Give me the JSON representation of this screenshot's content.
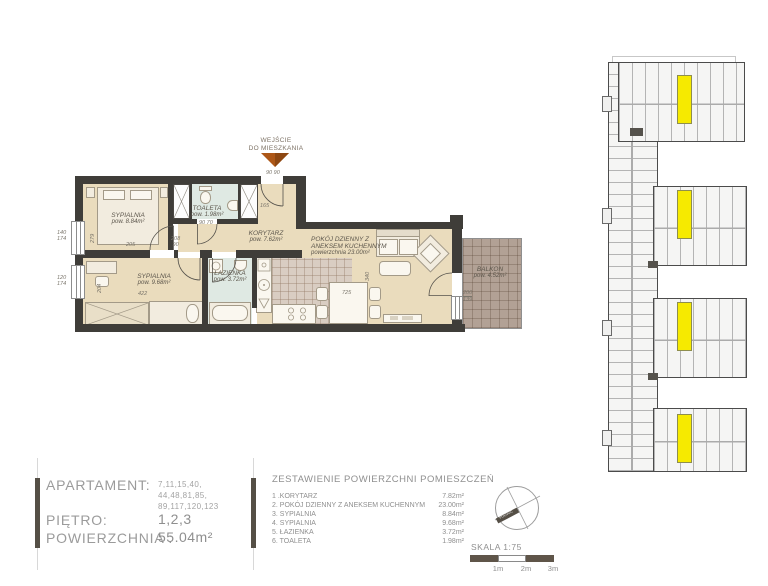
{
  "plan": {
    "entrance": {
      "line1": "WEJŚCIE",
      "line2": "DO MIESZKANIA"
    },
    "rooms": {
      "bedroom1": {
        "name": "SYPIALNIA",
        "area": "pow. 8.84m²"
      },
      "toilet": {
        "name": "TOALETA",
        "area": "pow. 1.98m²"
      },
      "corridor": {
        "name": "KORYTARZ",
        "area": "pow. 7.62m²"
      },
      "living": {
        "name_line1": "POKÓJ DZIENNY Z",
        "name_line2": "ANEKSEM KUCHENNYM",
        "area": "powierzchnia 23.00m²"
      },
      "bedroom2": {
        "name": "SYPIALNIA",
        "area": "pow. 9.68m²"
      },
      "bathroom": {
        "name": "ŁAZIENKA",
        "area": "pow. 3.72m²"
      },
      "balcony": {
        "name": "BALKON",
        "area": "pow. 4.52m²"
      }
    },
    "dims": {
      "bedroom1_w": "205",
      "bedroom1_h": "279",
      "bedroom1_door": "208",
      "bedroom1_door_w": "90",
      "window1_w": "140",
      "window1_h": "174",
      "window2_w": "120",
      "window2_h": "174",
      "bedroom2_h": "204",
      "bedroom2_w": "422",
      "entrance_a": "90",
      "entrance_b": "90",
      "corridor_w": "165",
      "toilet_door_a": "90",
      "toilet_door_b": "70",
      "living_d": "340",
      "dining_w": "725",
      "balcony_a": "200",
      "balcony_b": "139"
    }
  },
  "info": {
    "apartment_label": "APARTAMENT:",
    "apartment_numbers": [
      "7,11,15,40,",
      "44,48,81,85,",
      "89,117,120,123"
    ],
    "floor_label": "PIĘTRO:",
    "floor_value": "1,2,3",
    "area_label": "POWIERZCHNIA :",
    "area_value": "55.04m²"
  },
  "room_table": {
    "title": "ZESTAWIENIE POWIERZCHNI  POMIESZCZEŃ",
    "rows": [
      {
        "no": "1 .",
        "name": "KORYTARZ",
        "area": "7.82m²"
      },
      {
        "no": "2. ",
        "name": "POKÓJ DZIENNY Z ANEKSEM KUCHENNYM",
        "area": "23.00m²"
      },
      {
        "no": "3. ",
        "name": "SYPIALNIA",
        "area": "8.84m²"
      },
      {
        "no": "4. ",
        "name": "SYPIALNIA",
        "area": "9.68m²"
      },
      {
        "no": "5. ",
        "name": "ŁAZIENKA",
        "area": "3.72m²"
      },
      {
        "no": "6. ",
        "name": "TOALETA",
        "area": "1.98m²"
      }
    ]
  },
  "compass": {
    "label": "PÓŁNOC"
  },
  "scale": {
    "label": "SKALA 1:75",
    "tick1": "1m",
    "tick2": "2m",
    "tick3": "3m"
  },
  "colors": {
    "wall": "#3f3d39",
    "floor": "#eadcbd",
    "wet_floor": "#dfe9e3",
    "tile_floor": "#d9cdc2",
    "balcony_floor": "#b2a195",
    "highlight": "#f6ea00",
    "arrow": "#ad5717"
  }
}
